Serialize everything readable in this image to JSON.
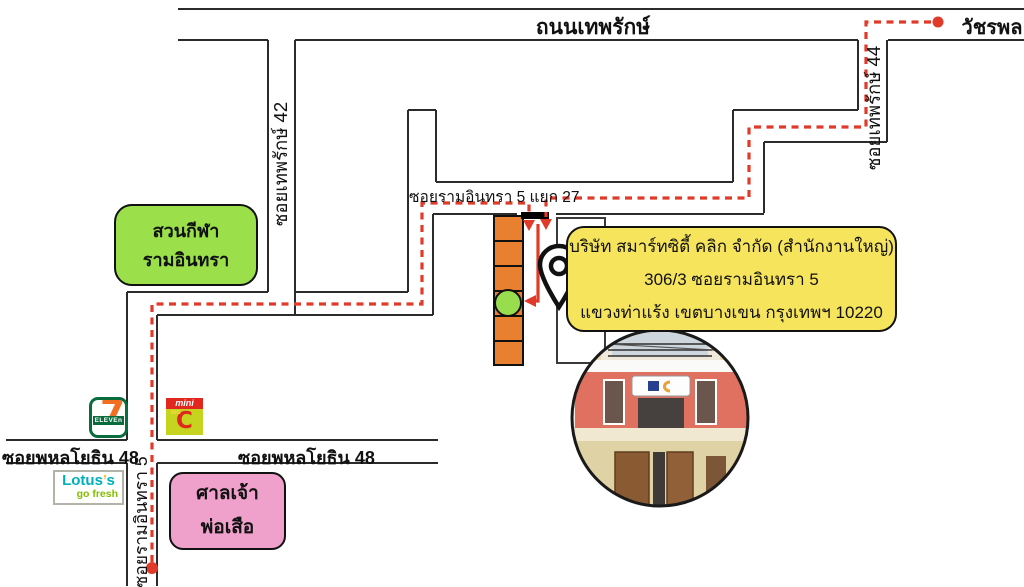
{
  "roads": {
    "thanon_theprak": "ถนนเทพรักษ์",
    "watcharaphon": "วัชรพล",
    "soi_theprak_42": "ซอยเทพรักษ์ 42",
    "soi_theprak_44": "ซอยเทพรักษ์ 44",
    "soi_ram_inthra_5_yaek_27": "ซอยรามอินทรา 5 แยก 27",
    "soi_phahonyothin_48": "ซอยพหลโยธิน 48",
    "soi_ram_inthra_5": "ซอยรามอินทรา 5"
  },
  "places": {
    "sports_park": "สวนกีฬารามอินทรา",
    "shrine_line1": "ศาลเจ้า",
    "shrine_line2": "พ่อเสือ"
  },
  "address_card": {
    "line1": "บริษัท สมาร์ทซิตี้ คลิก จำกัด (สำนักงานใหญ่)",
    "line2": "306/3 ซอยรามอินทรา 5",
    "line3": "แขวงท่าแร้ง เขตบางเขน กรุงเทพฯ 10220"
  },
  "logos": {
    "seven_eleven": {
      "seven": "7",
      "eleven": "ELEVEn"
    },
    "mini_big_c": {
      "mini": "mini",
      "big": "BIG",
      "c": "C"
    },
    "lotus": {
      "part1": "Lotus",
      "apostrophe": "’",
      "part2": "s",
      "tagline": "go fresh"
    }
  },
  "colors": {
    "route_red": "#e03a2a",
    "road_gray": "#2b2b2b",
    "park_green": "#9be04b",
    "shrine_pink": "#efa0cb",
    "card_yellow": "#f6e45c",
    "block_orange": "#e8802f",
    "unit_green": "#98dd4e",
    "seven_green": "#0a6b3c",
    "seven_orange": "#f26f21",
    "bigc_lime": "#c6d420",
    "bigc_red": "#e0281e",
    "lotus_teal": "#00b0b9",
    "lotus_green": "#84bd00"
  }
}
